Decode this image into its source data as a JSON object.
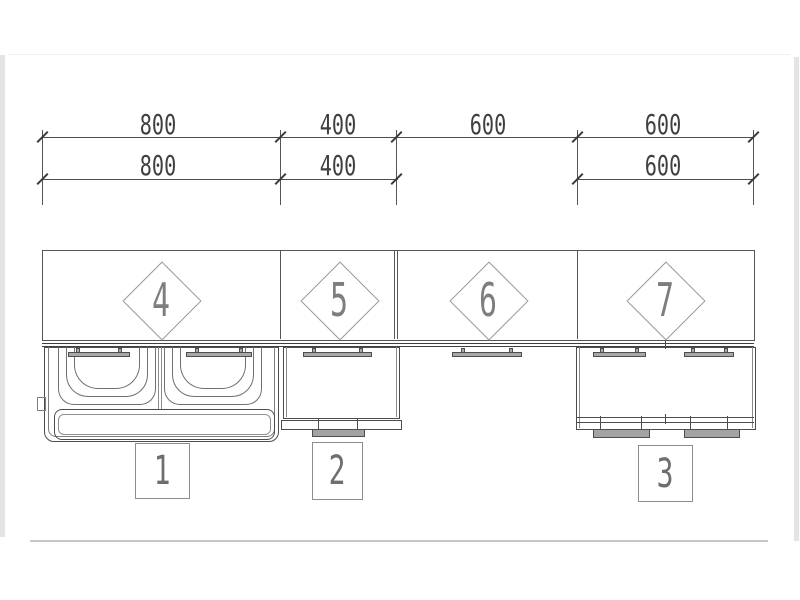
{
  "drawing_type": "kitchen cabinet elevation with dimension chain",
  "dimensions": {
    "row1": [
      "800",
      "400",
      "600",
      "600"
    ],
    "row2": [
      "800",
      "400",
      "600"
    ]
  },
  "cabinet_numbers": [
    "4",
    "5",
    "6",
    "7"
  ],
  "position_numbers": [
    "1",
    "2",
    "3"
  ],
  "colors": {
    "line": "#4d4d4d",
    "dim_text": "#3f3f3f",
    "tag_text": "#7e7e7e",
    "position_text": "#6e6e6e",
    "handle_fill": "#a8a8a8",
    "page_frame": "#e4e4e7"
  }
}
